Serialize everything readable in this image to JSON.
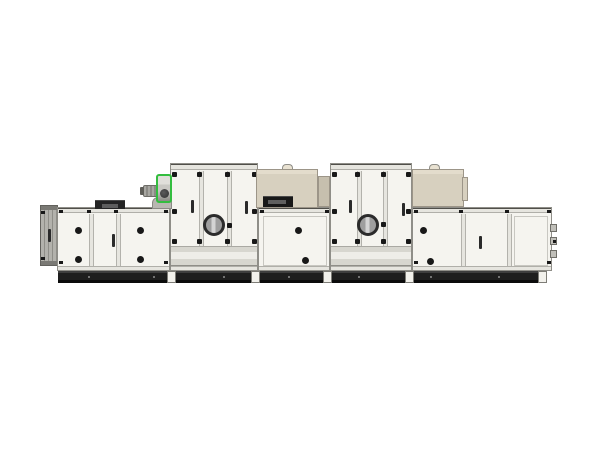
{
  "scene": {
    "subject": "modular air handling / desiccant dehumidifier unit, side product view on white background",
    "text_content": "none visible"
  },
  "colors": {
    "background": "#ffffff",
    "panel": "#f5f4ef",
    "panel-edge": "#8f8e88",
    "panel-line": "#c8c7c1",
    "frame": "#e6e5df",
    "band": "#d7d6cf",
    "black": "#181818",
    "base": "#1e1e1e",
    "base-top": "#3e3e3e",
    "base-dark": "#0b0b0b",
    "bolt": "#8e8e8e",
    "foot": "#f2f1ec",
    "beige-front": "#d7d0bf",
    "beige-top": "#e3dccc",
    "beige-side": "#c6bfae",
    "beige-edge": "#9c9588",
    "slot-inner": "#5f5f5f",
    "green": "#33bd3f",
    "scroll-dark": "#303030",
    "motor": "#a8a7a2",
    "motor-dark": "#8c8b86",
    "louver": "#b3b2ac",
    "louver-dark": "#62615c",
    "ring": "#2b2b2b",
    "glass": "#9e9e9e",
    "glass-stripe": "#d4d4d4",
    "hood": "#242424",
    "hood-slot": "#5e5e5e"
  },
  "machine": {
    "sections": [
      {
        "id": "louver-end-cap",
        "type": "louvered intake damper",
        "position": "far left",
        "handles": 1
      },
      {
        "id": "section-1",
        "type": "low cabinet",
        "door_panels": 3,
        "knobs": 4,
        "handles": 1,
        "roof": [
          "exhaust hood",
          "fan scroll with green trim and motor"
        ]
      },
      {
        "id": "section-2",
        "type": "tall cabinet",
        "door_panels": 3,
        "portholes": 1,
        "handles": 2,
        "corner_brackets": true
      },
      {
        "id": "section-3",
        "type": "low cabinet",
        "door_panels": 1,
        "knobs": 2,
        "roof": [
          "beige control box with lid handle, slot vent and side step"
        ]
      },
      {
        "id": "section-4",
        "type": "tall cabinet",
        "door_panels": 3,
        "portholes": 1,
        "handles": 2,
        "corner_brackets": true
      },
      {
        "id": "section-5",
        "type": "low cabinet",
        "door_panels": 3,
        "knobs": 2,
        "handles": 1,
        "roof": [
          "beige control box with lid handle"
        ],
        "right_edge_hinge_tabs": 3
      }
    ],
    "base": {
      "style": "dark skid rail",
      "support_feet": 5,
      "bolt_dots": true
    }
  }
}
